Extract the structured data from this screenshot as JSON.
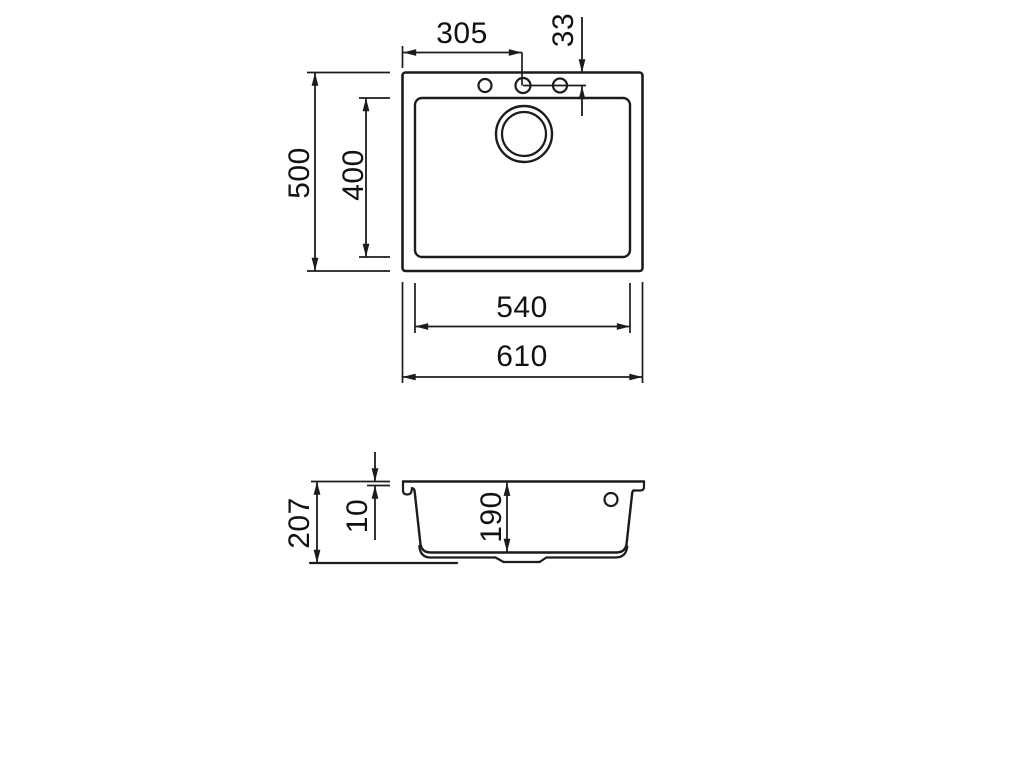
{
  "top_view": {
    "label": "plan-view",
    "dims": {
      "overall_width": "610",
      "overall_depth": "500",
      "bowl_width": "540",
      "bowl_depth": "400",
      "tap_hole_offset_x": "305",
      "tap_hole_offset_y": "33"
    },
    "features": {
      "tap_holes": 3,
      "drain_hole": 1
    }
  },
  "section_view": {
    "label": "front-section-view",
    "dims": {
      "overall_height": "207",
      "rim_thickness": "10",
      "bowl_inner_depth": "190"
    },
    "features": {
      "overflow_hole": 1
    }
  },
  "colors": {
    "line": "#1c1c1c",
    "background": "#ffffff"
  }
}
